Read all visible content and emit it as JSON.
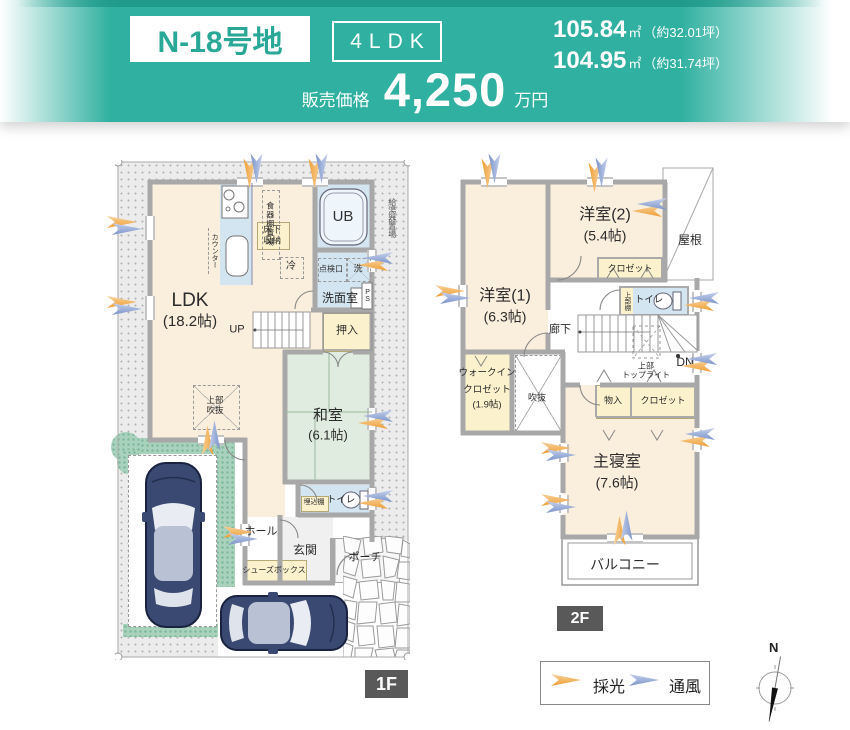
{
  "header": {
    "lot": "N-18号地",
    "plan_type": "4LDK",
    "price_label": "販売価格",
    "price_value": "4,250",
    "price_unit": "万円",
    "area1_value": "105.84",
    "area1_unit": "㎡",
    "area1_tsubo": "（約32.01坪）",
    "area2_value": "104.95",
    "area2_unit": "㎡",
    "area2_tsubo": "（約31.74坪）"
  },
  "floor1": {
    "badge": "1F",
    "ldk_name": "LDK",
    "ldk_size": "(18.2帖)",
    "washitsu_name": "和室",
    "washitsu_size": "(6.1帖)",
    "counter": "カウンター",
    "dish_shelf": "食器棚置場",
    "underfloor_storage": "床下収納",
    "fridge": "冷",
    "ub": "UB",
    "inspection": "点検口",
    "washer": "洗",
    "washroom": "洗面室",
    "ps": "PS",
    "up": "UP",
    "oshiire": "押入",
    "void_above_1": "上部",
    "void_above_2": "吹抜",
    "builtin_shelf": "埋込棚",
    "toilet": "トイレ",
    "hall": "ホール",
    "entrance": "玄関",
    "porch": "ポーチ",
    "shoe_box": "シューズボックス",
    "water_heater": "給湯器置場"
  },
  "floor2": {
    "badge": "2F",
    "room1_name": "洋室(1)",
    "room1_size": "(6.3帖)",
    "room2_name": "洋室(2)",
    "room2_size": "(5.4帖)",
    "roof": "屋根",
    "closet_room2": "クロゼット",
    "upper_shelf": "上部棚",
    "toilet": "トイレ",
    "corridor": "廊下",
    "dn": "DN",
    "toplight_1": "上部",
    "toplight_2": "トップライト",
    "storage": "物入",
    "closet_master": "クロゼット",
    "wic_1": "ウォークイン",
    "wic_2": "クロゼット",
    "wic_3": "(1.9帖)",
    "void": "吹抜",
    "master_name": "主寝室",
    "master_size": "(7.6帖)",
    "balcony": "バルコニー"
  },
  "legend": {
    "daylight": "採光",
    "ventilation": "通風",
    "north": "N"
  },
  "colors": {
    "teal": "#2fb0a0",
    "teal_dark": "#1f9a8b",
    "teal_text": "#2aa897",
    "cream": "#faeedd",
    "blue": "#d3e5f0",
    "tatami": "#e0ecdf",
    "yellow": "#fbf2cd",
    "wall": "#a8a8a8",
    "garden": "#a9d2bd",
    "badge": "#595959",
    "arrow_orange": "#f0a445",
    "arrow_blue": "#8aa0d0",
    "line": "#999999"
  }
}
